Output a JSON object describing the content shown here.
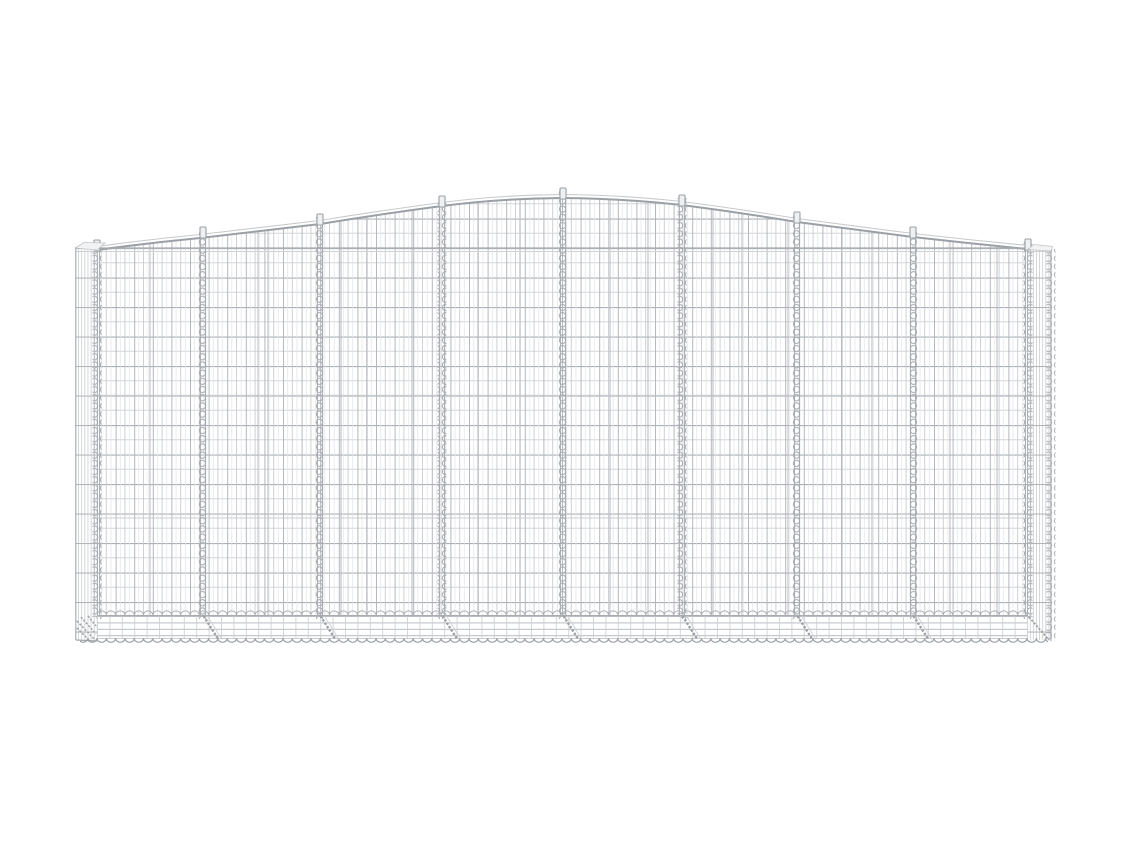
{
  "scene": {
    "type": "product-photo",
    "subject": "Arched gabion basket of galvanized silver iron wire mesh",
    "alt": "Front view of an arched gabion wire basket on a plain white background: a long rectangular galvanized-iron mesh cage whose top edge rises in a gentle arch to a peak at the center, divided into eight mesh sections by nine vertical spiral coil joints, with a narrow mesh end panel on each side and a shallow mesh base strip finished with scalloped wire loops and diagonal coil struts along the bottom edge",
    "background_color": "#ffffff",
    "structure": {
      "front_panels": 8,
      "spiral_joints": 9,
      "top_profile": "center-peaked arch",
      "base": "scalloped wire bottom edge with diagonal struts at each joint"
    },
    "palette": {
      "wire_light": "#d6d8db",
      "wire_mid": "#aab0b5",
      "wire_dark": "#8f959a",
      "background": "#ffffff"
    }
  }
}
